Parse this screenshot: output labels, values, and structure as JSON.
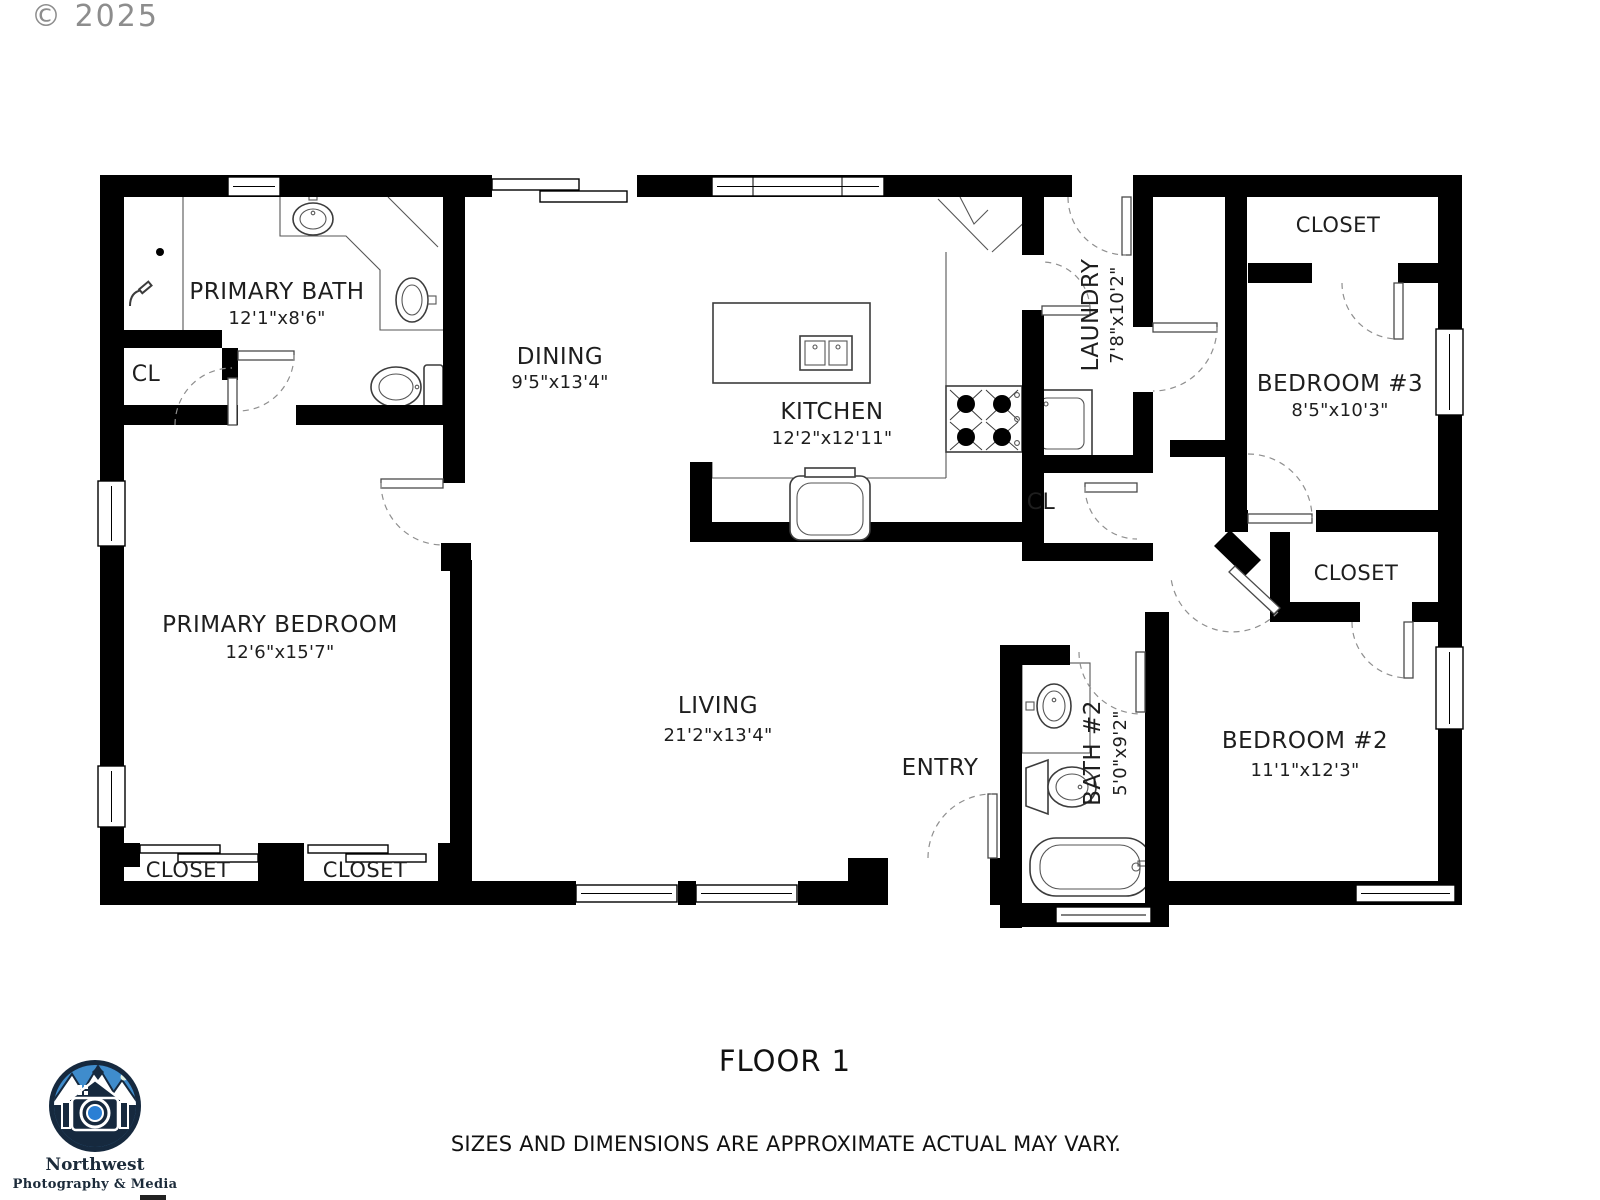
{
  "watermark": "© 2025",
  "footer": {
    "floor_label": "FLOOR 1",
    "disclaimer": "SIZES AND DIMENSIONS ARE APPROXIMATE ACTUAL MAY VARY."
  },
  "logo": {
    "name": "Northwest",
    "tagline": "Photography & Media",
    "colors": {
      "navy": "#16293e",
      "sky_blue": "#3f8ccc",
      "lens_blue": "#2a7fd4"
    }
  },
  "colors": {
    "wall": "#000000",
    "fixture_line": "#3c3c3c",
    "door_arc": "#8f8f8f",
    "watermark_gray": "#8d8d8d"
  },
  "rooms": {
    "primary_bath": {
      "name": "PRIMARY BATH",
      "dims": "12'1\"x8'6\""
    },
    "bath_closet": {
      "name": "CL"
    },
    "dining": {
      "name": "DINING",
      "dims": "9'5\"x13'4\""
    },
    "kitchen": {
      "name": "KITCHEN",
      "dims": "12'2\"x12'11\""
    },
    "laundry": {
      "name": "LAUNDRY",
      "dims": "7'8\"x10'2\""
    },
    "bedroom3_closet": {
      "name": "CLOSET"
    },
    "bedroom3": {
      "name": "BEDROOM #3",
      "dims": "8'5\"x10'3\""
    },
    "hall_closet": {
      "name": "CL"
    },
    "primary_bedroom": {
      "name": "PRIMARY BEDROOM",
      "dims": "12'6\"x15'7\""
    },
    "living": {
      "name": "LIVING",
      "dims": "21'2\"x13'4\""
    },
    "entry": {
      "name": "ENTRY"
    },
    "bath2": {
      "name": "BATH #2",
      "dims": "5'0\"x9'2\""
    },
    "bedroom2": {
      "name": "BEDROOM #2",
      "dims": "11'1\"x12'3\""
    },
    "bedroom2_closet": {
      "name": "CLOSET"
    },
    "primary_closet_left": {
      "name": "CLOSET"
    },
    "primary_closet_right": {
      "name": "CLOSET"
    }
  }
}
